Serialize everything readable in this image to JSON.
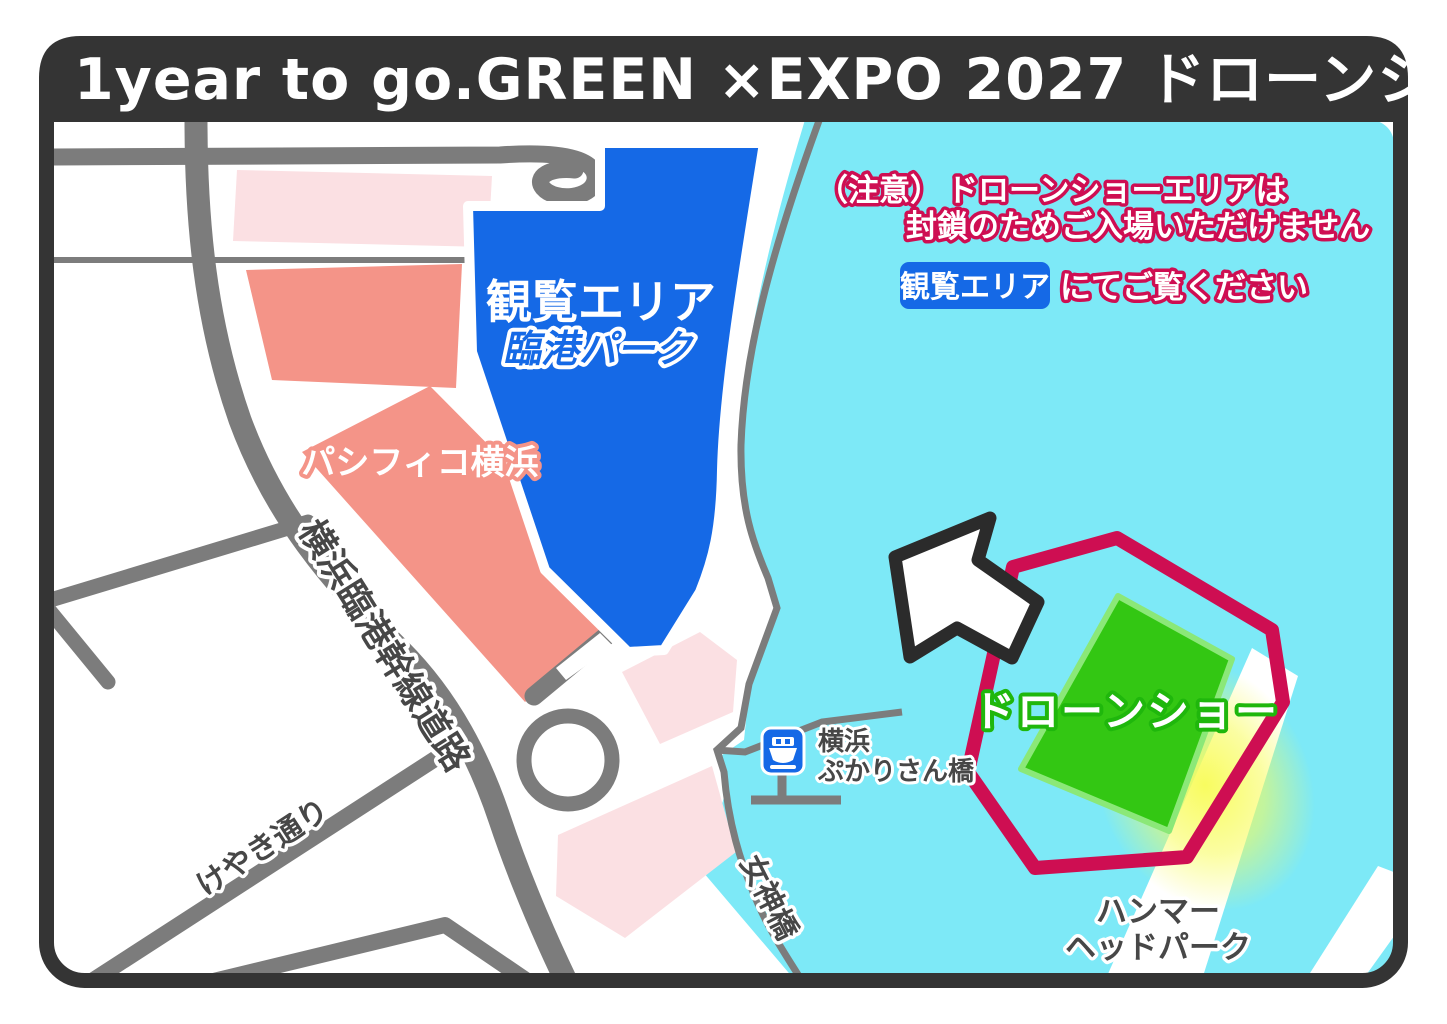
{
  "header": {
    "title": "1year to go.GREEN ×EXPO 2027 ドローンショー",
    "bg_color": "#343434",
    "text_color": "#ffffff"
  },
  "notice": {
    "caution_prefix": "（注意）",
    "line1": "ドローンショーエリアは",
    "line2": "封鎖のためご入場いただけません",
    "badge_label": "観覧エリア",
    "line3": "にてご覧ください",
    "accent_color": "#CE0E52",
    "badge_bg_color": "#1569E6"
  },
  "areas": {
    "viewing": {
      "label": "観覧エリア",
      "sublabel": "臨港パーク",
      "fill_color": "#1569E6"
    },
    "pacifico": {
      "label": "パシフィコ横浜",
      "fill_color": "#F49488"
    },
    "drone_show": {
      "label": "ドローンショー",
      "outline_color": "#CE0E52",
      "field_color": "#33C713",
      "glow_color": "#F8FC57"
    },
    "hammerhead": {
      "line1": "ハンマー",
      "line2": "ヘッドパーク"
    }
  },
  "roads": {
    "rinko_kansen": "横浜臨港幹線道路",
    "keyaki": "けやき通り",
    "megamibashi": "女神橋",
    "road_color": "#7C7C7C"
  },
  "pier": {
    "icon": "ferry-icon",
    "line1": "横浜",
    "line2": "ぷかりさん橋"
  },
  "map": {
    "water_color": "#7DE9F7",
    "land_color": "#ffffff",
    "arrow": "northwest-arrow"
  }
}
